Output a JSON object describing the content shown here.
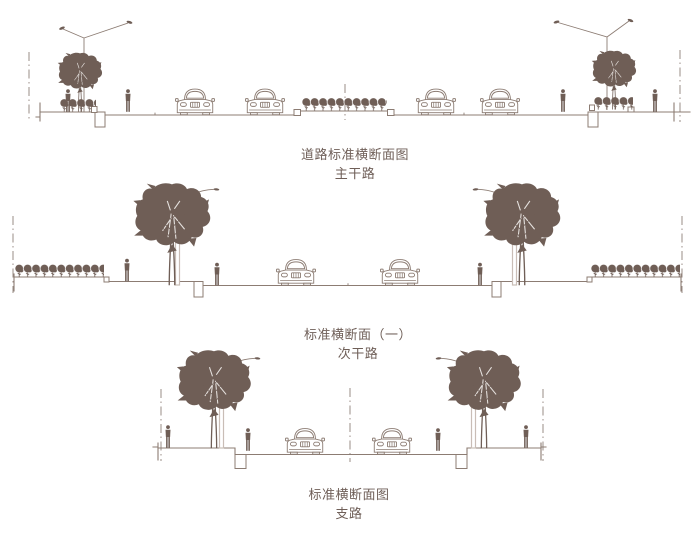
{
  "canvas": {
    "width": 700,
    "height": 542,
    "background": "#ffffff"
  },
  "palette": {
    "line_color": "#8c7c73",
    "solid_fill": "#6f5e56",
    "lamp_pole_color": "#c9bdb6",
    "text_color": "#6f5f58"
  },
  "sections": [
    {
      "id": "main-road",
      "caption_line1": "道路标准横断面图",
      "caption_line2": "主干路",
      "contents": {
        "streetlights": 2,
        "trees": 2,
        "shrub_rows": 3,
        "cars": 4,
        "pedestrians": 4,
        "boundary_lines": 2,
        "median_axis_lines": 1,
        "drain_pits": 2
      }
    },
    {
      "id": "secondary-road",
      "caption_line1": "标准横断面（一）",
      "caption_line2": "次干路",
      "contents": {
        "street_lamps": 2,
        "trees": 2,
        "shrub_rows": 2,
        "cars": 2,
        "pedestrians": 3,
        "boundary_lines": 2,
        "drain_pits": 2
      }
    },
    {
      "id": "branch-road",
      "caption_line1": "标准横断面图",
      "caption_line2": "支路",
      "contents": {
        "street_lamps": 2,
        "trees": 2,
        "cars": 2,
        "pedestrians": 4,
        "boundary_lines": 2,
        "center_axis_lines": 1,
        "drain_pits": 2
      }
    }
  ]
}
